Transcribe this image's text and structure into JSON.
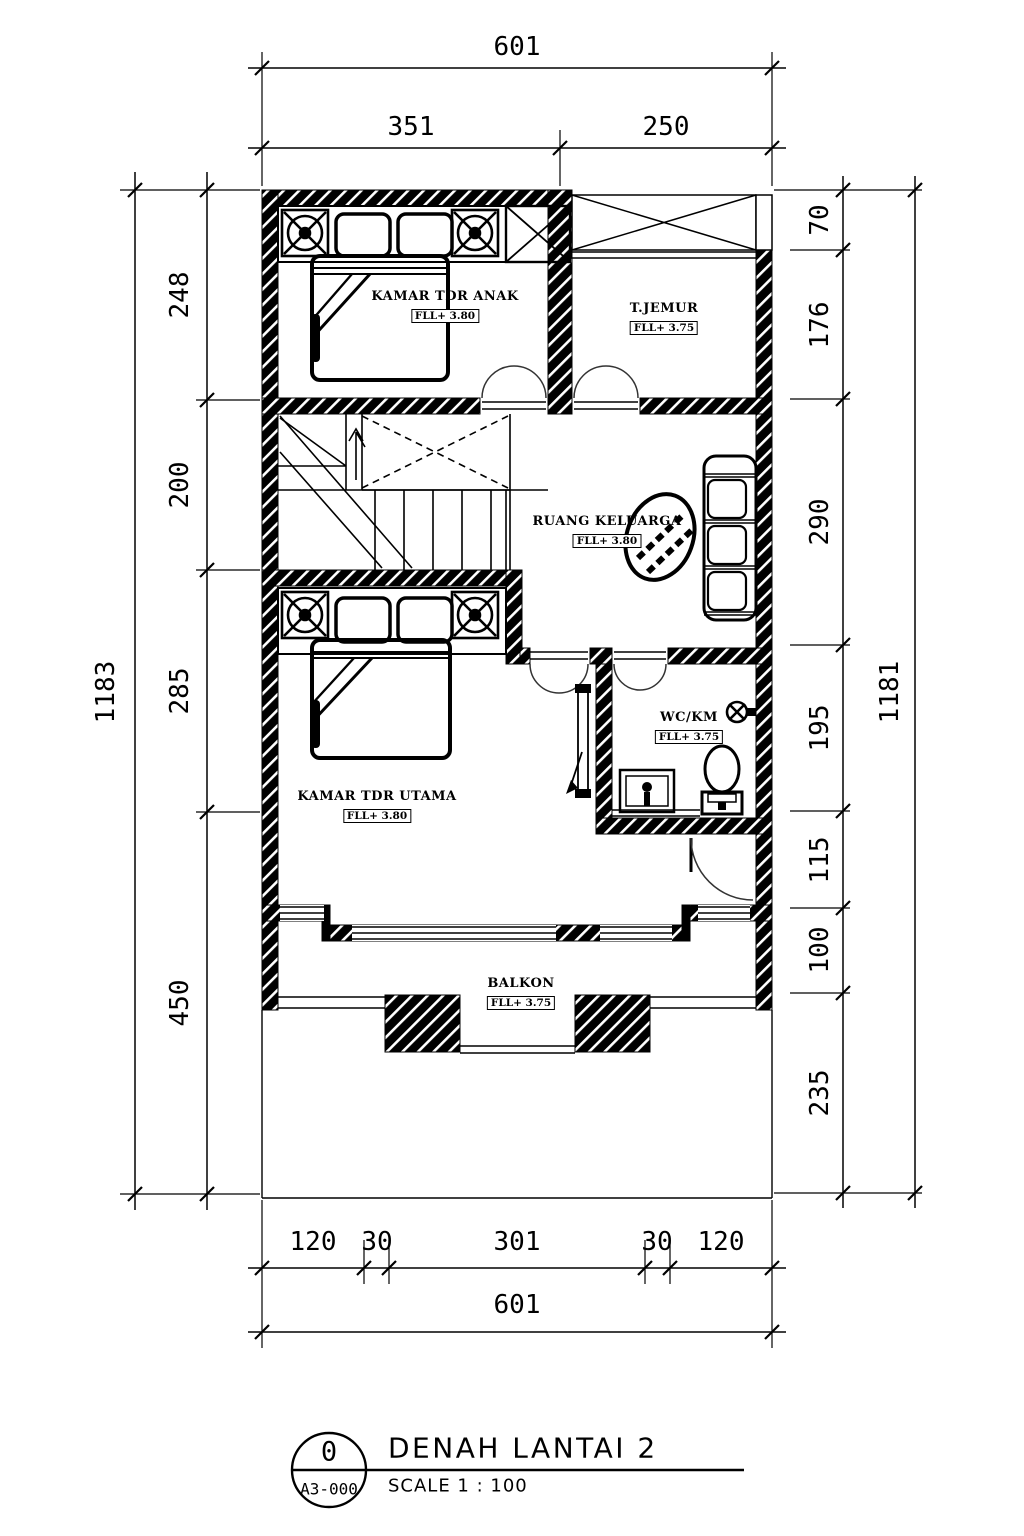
{
  "title_block": {
    "drawing_number": "0",
    "sheet_code": "A3-000",
    "title": "DENAH LANTAI 2",
    "scale_label": "SCALE 1 : 100"
  },
  "rooms": [
    {
      "name": "KAMAR TDR ANAK",
      "elevation": "FLL+ 3.80"
    },
    {
      "name": "T.JEMUR",
      "elevation": "FLL+ 3.75"
    },
    {
      "name": "RUANG KELUARGA",
      "elevation": "FLL+ 3.80"
    },
    {
      "name": "KAMAR TDR UTAMA",
      "elevation": "FLL+ 3.80"
    },
    {
      "name": "WC/KM",
      "elevation": "FLL+ 3.75"
    },
    {
      "name": "BALKON",
      "elevation": "FLL+ 3.75"
    }
  ],
  "dimensions": {
    "top": {
      "overall": "601",
      "segments": [
        "351",
        "250"
      ]
    },
    "bottom": {
      "overall": "601",
      "segments": [
        "120",
        "30",
        "301",
        "30",
        "120"
      ]
    },
    "left": {
      "overall": "1183",
      "segments": [
        "248",
        "200",
        "285",
        "450"
      ]
    },
    "right": {
      "overall": "1181",
      "segments": [
        "70",
        "176",
        "290",
        "195",
        "115",
        "100",
        "235"
      ]
    }
  },
  "colors": {
    "line": "#000000",
    "background": "#ffffff"
  }
}
